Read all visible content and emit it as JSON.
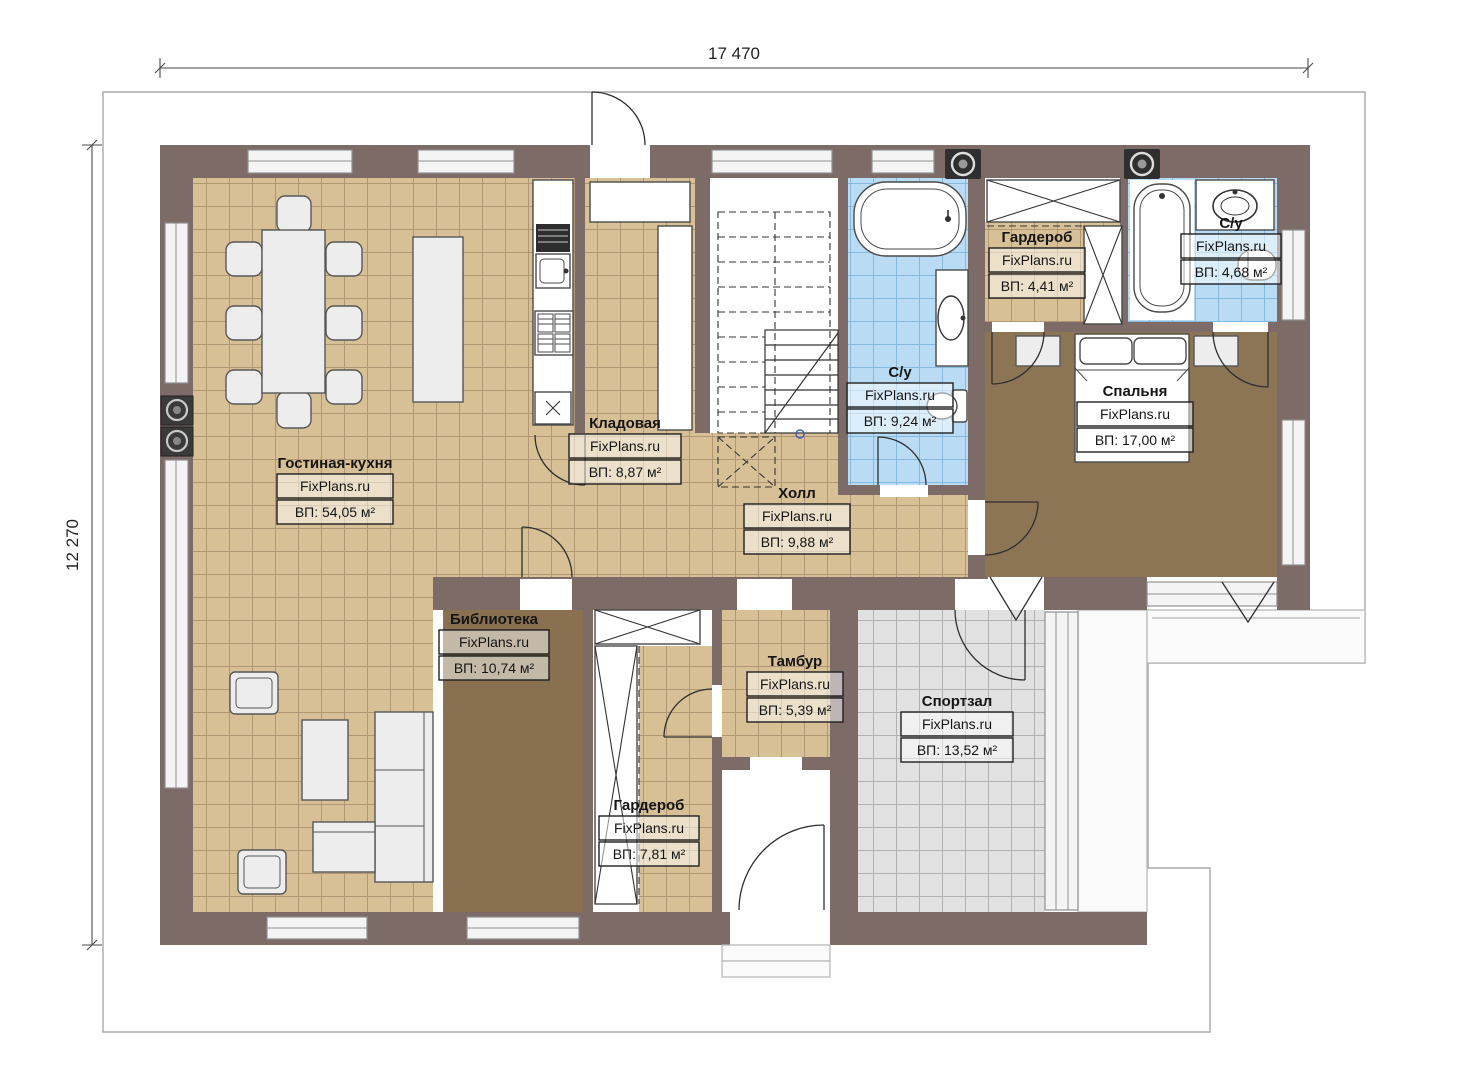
{
  "dimensions": {
    "top": "17 470",
    "left": "12 270"
  },
  "rooms": [
    {
      "id": "living-kitchen",
      "name": "Гостиная-кухня",
      "watermark": "FixPlans.ru",
      "area": "ВП: 54,05 м²"
    },
    {
      "id": "pantry",
      "name": "Кладовая",
      "watermark": "FixPlans.ru",
      "area": "ВП: 8,87 м²"
    },
    {
      "id": "hall",
      "name": "Холл",
      "watermark": "FixPlans.ru",
      "area": "ВП: 9,88 м²"
    },
    {
      "id": "bathroom-1",
      "name": "С/у",
      "watermark": "FixPlans.ru",
      "area": "ВП: 9,24 м²"
    },
    {
      "id": "wardrobe-1",
      "name": "Гардероб",
      "watermark": "FixPlans.ru",
      "area": "ВП: 4,41 м²"
    },
    {
      "id": "bathroom-2",
      "name": "С/у",
      "watermark": "FixPlans.ru",
      "area": "ВП: 4,68 м²"
    },
    {
      "id": "bedroom",
      "name": "Спальня",
      "watermark": "FixPlans.ru",
      "area": "ВП: 17,00 м²"
    },
    {
      "id": "library",
      "name": "Библиотека",
      "watermark": "FixPlans.ru",
      "area": "ВП: 10,74 м²"
    },
    {
      "id": "vestibule",
      "name": "Тамбур",
      "watermark": "FixPlans.ru",
      "area": "ВП: 5,39 м²"
    },
    {
      "id": "gym",
      "name": "Спортзал",
      "watermark": "FixPlans.ru",
      "area": "ВП: 13,52 м²"
    },
    {
      "id": "wardrobe-2",
      "name": "Гардероб",
      "watermark": "FixPlans.ru",
      "area": "ВП: 7,81 м²"
    }
  ],
  "colors": {
    "wall": "#7d6b68",
    "tile_tan": "#d8c096",
    "tile_blue": "#b9dcf4",
    "tile_gray": "#e1e1e1",
    "wood_dark": "#8c7555",
    "background": "#ffffff"
  }
}
